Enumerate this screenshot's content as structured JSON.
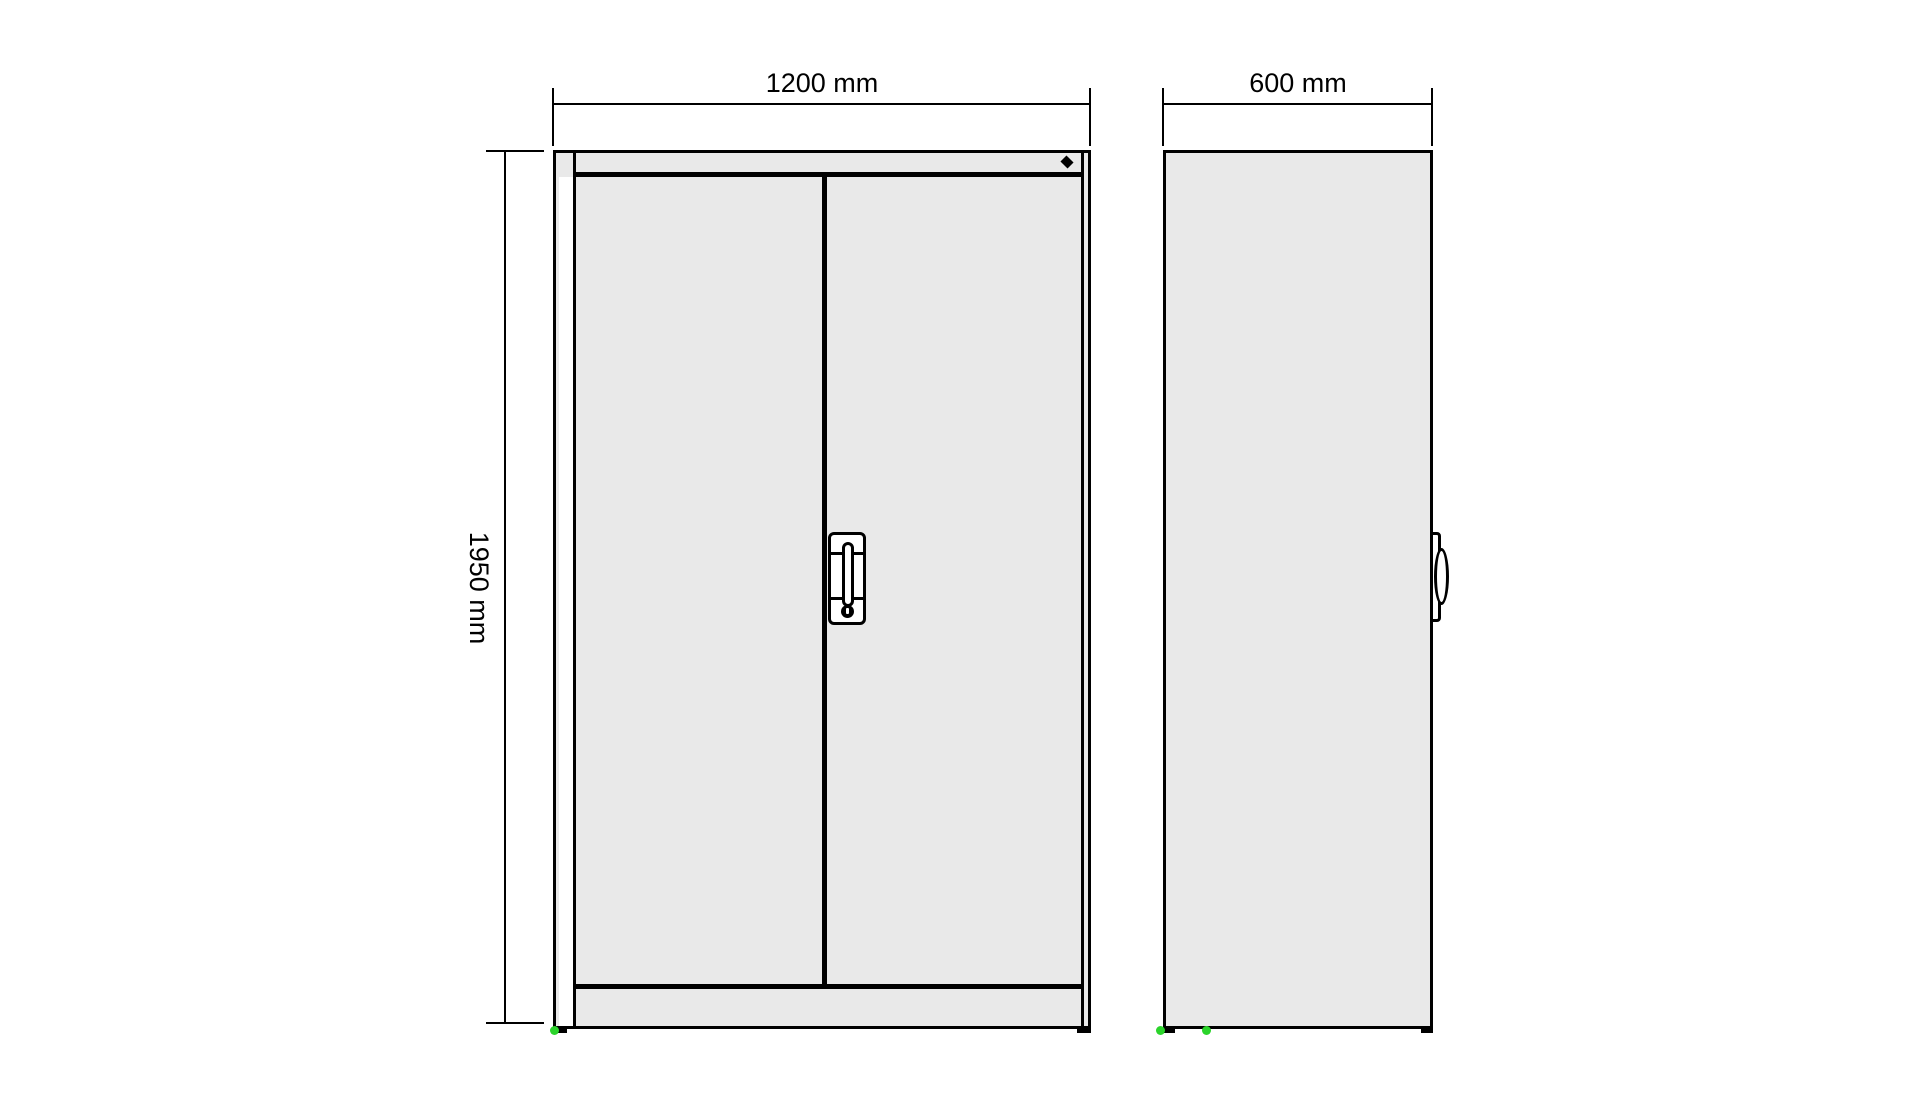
{
  "page": {
    "background": "#ffffff"
  },
  "drawing": {
    "kind": "cabinet elevation (front and side view) with dimension annotations",
    "line_color": "#000000",
    "panel_fill": "#e9e9e9",
    "marker_color": "#2bd42b",
    "front_view": {
      "width_label": "1200 mm",
      "width_mm": 1200,
      "height_label": "1950 mm",
      "height_mm": 1950,
      "features": [
        "two doors",
        "center divider",
        "handle plate with grip and keyhole",
        "lock diamond top-right",
        "base feet",
        "green corner marker"
      ]
    },
    "side_view": {
      "depth_label": "600 mm",
      "depth_mm": 600,
      "features": [
        "door handle profile on front edge",
        "base feet",
        "two green markers"
      ]
    }
  }
}
